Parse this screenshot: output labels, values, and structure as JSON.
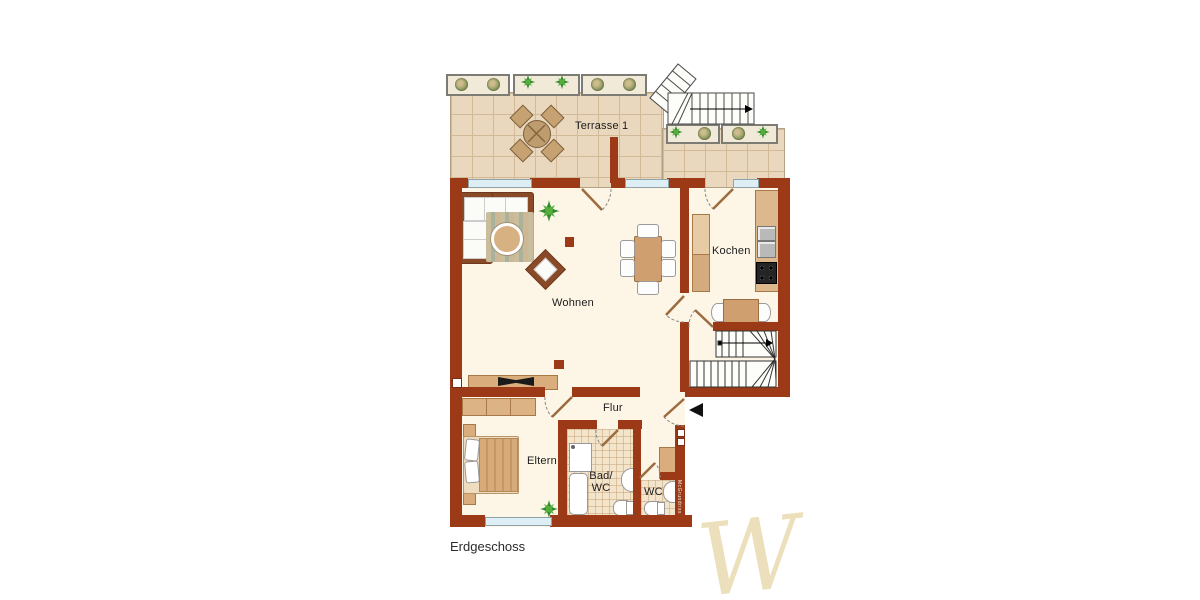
{
  "title": "Erdgeschoss",
  "rooms": {
    "terrace": "Terrasse 1",
    "living": "Wohnen",
    "kitchen": "Kochen",
    "hall": "Flur",
    "parents": "Eltern",
    "bath_top": "Bad/",
    "bath_bottom": "WC",
    "wc": "WC"
  },
  "watermark": {
    "signature": "W",
    "wall_label": "McGrundriss"
  },
  "colors": {
    "wall": "#9c3917",
    "floor": "#fdf5e6",
    "terrace-tile": "#ead8be",
    "terrace-line": "#d2ba99",
    "furn": "#d9ad7c",
    "furn-dark": "#8a4a28",
    "furn-mid": "#cf9f6f",
    "window": "#ddeef5",
    "bath-tile": "#f3e4cc",
    "label": "#1c1c1c"
  }
}
